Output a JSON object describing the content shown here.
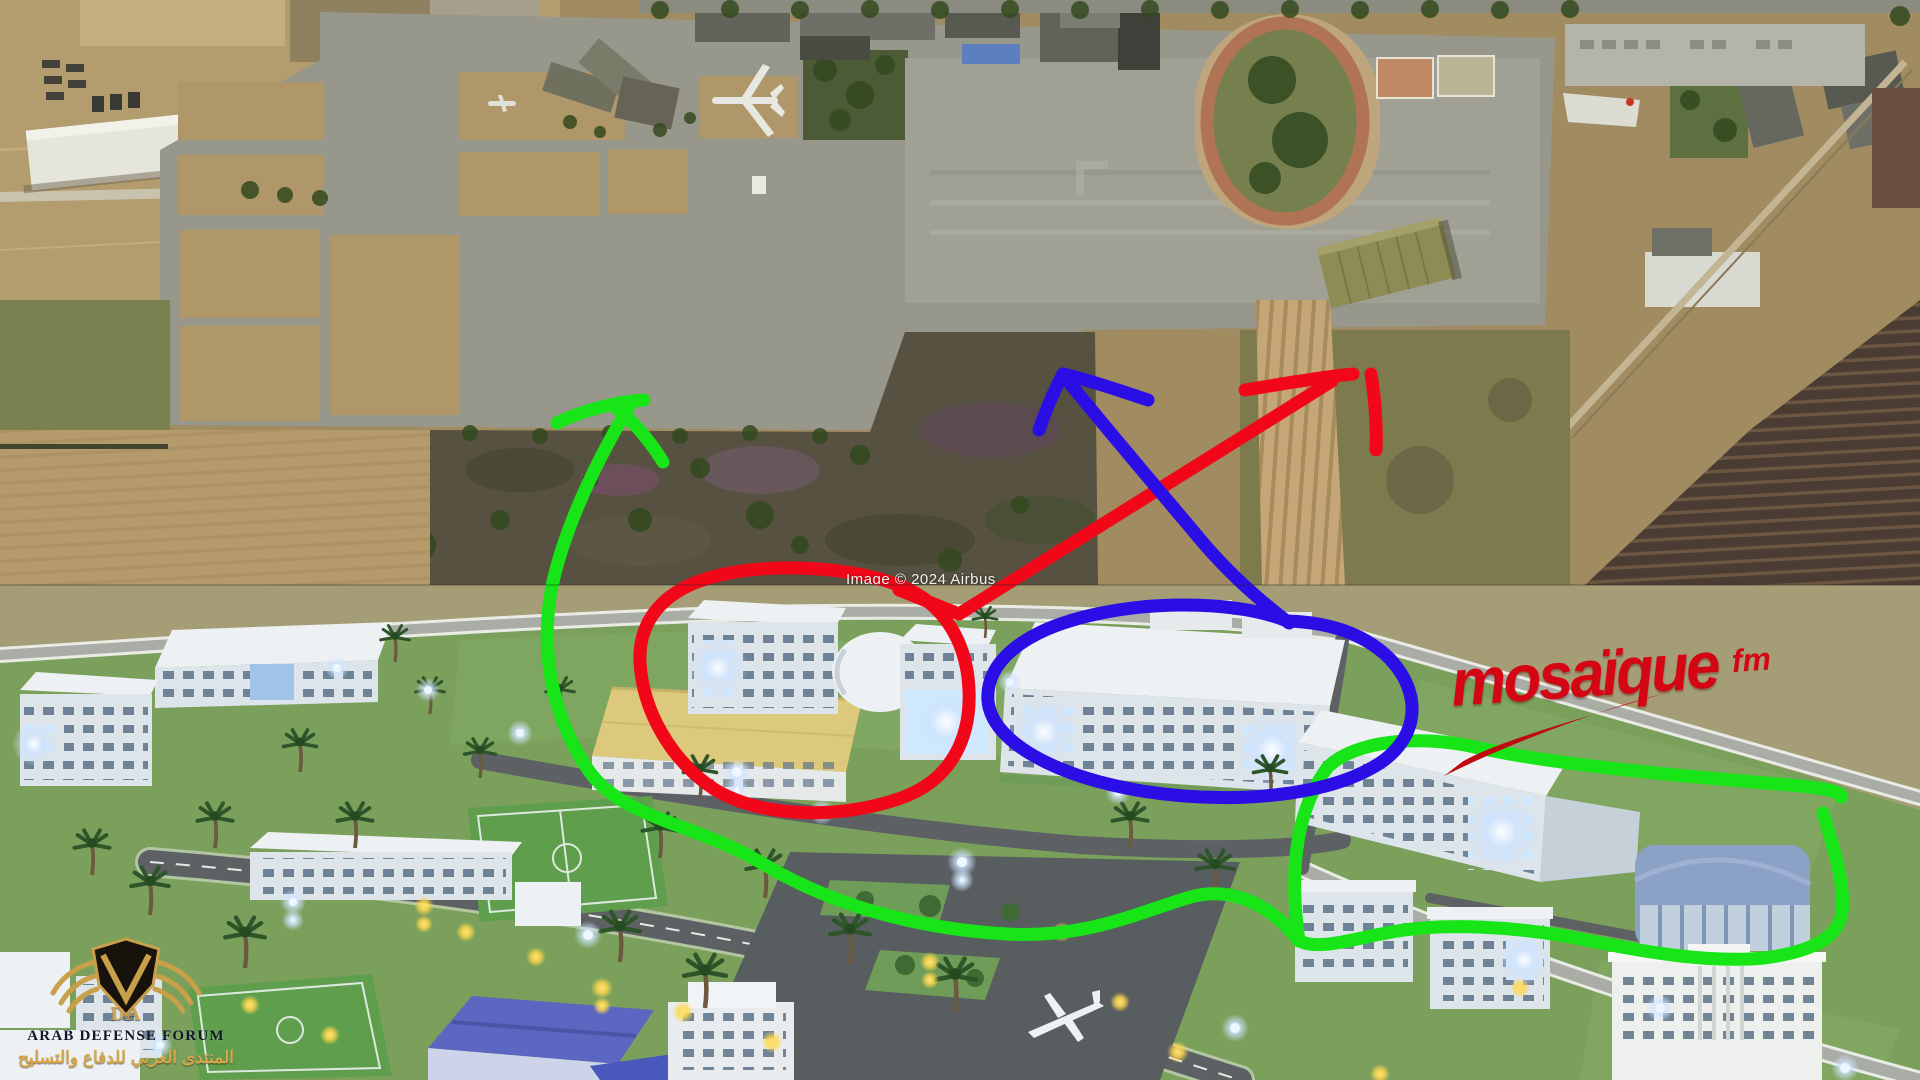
{
  "logo": {
    "wordmark": "mosaïque",
    "suffix": "fm",
    "color": "#d40613"
  },
  "satellite": {
    "copyright": "Image © 2024 Airbus"
  },
  "watermark": {
    "initials": "DA",
    "title": "ARAB DEFENSE FORUM",
    "subtitle_arabic": "المنتدى العربي للدفاع والتسليح",
    "gold": "#cfa14c"
  },
  "annotations": {
    "green": {
      "color": "#17e517",
      "shapes": [
        "arrow-up-left",
        "large-scribble-loop-center",
        "loop-around-right-complex"
      ]
    },
    "red": {
      "color": "#f20718",
      "shapes": [
        "ellipse-around-left-complex",
        "arrow-up-right"
      ]
    },
    "blue": {
      "color": "#2b0de6",
      "shapes": [
        "ellipse-around-center-complex",
        "arrow-up-left"
      ]
    }
  }
}
